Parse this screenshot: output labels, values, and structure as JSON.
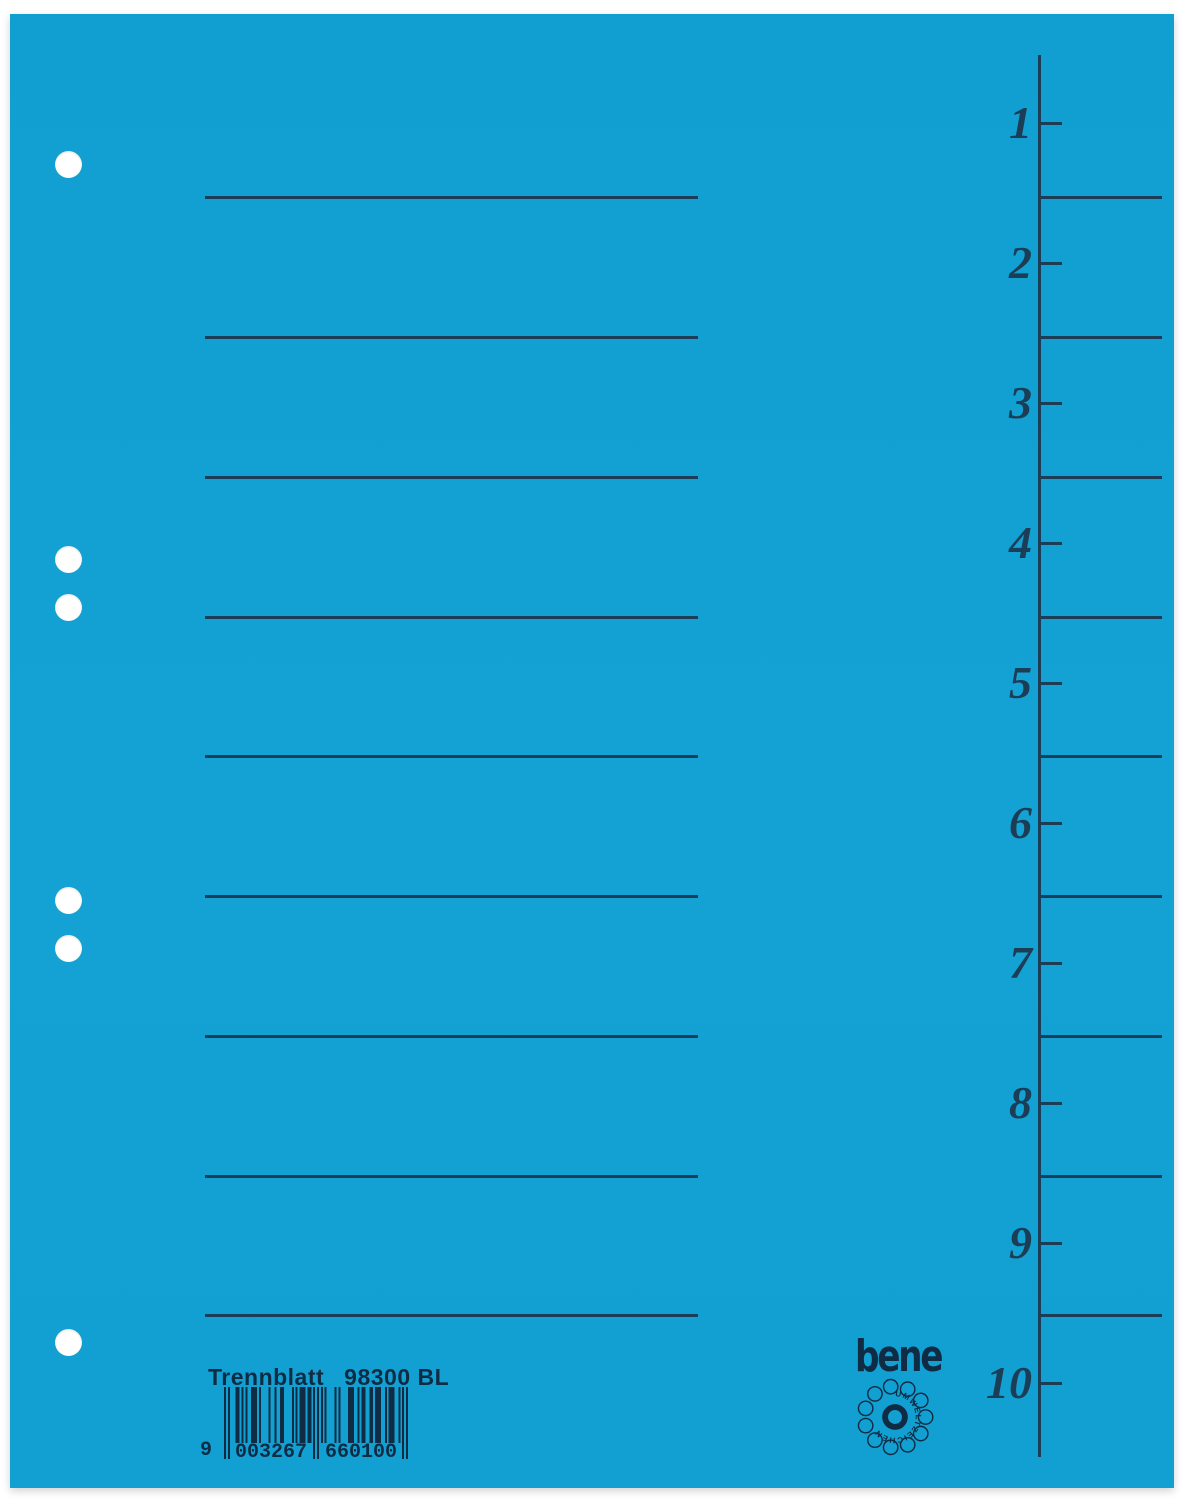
{
  "colors": {
    "sheet_blue": "#12a1d3",
    "mark_dark": "#1c3d56",
    "ink_dark": "#0f2c44",
    "hole_white": "#ffffff",
    "background_white": "#ffffff"
  },
  "product": {
    "label": "Trennblatt",
    "article": "98300 BL",
    "brand": "bene",
    "eco_text": "UMWELTZEICHEN"
  },
  "barcode": {
    "display": "9 003267 660100",
    "lead": "9",
    "group1": "003267",
    "group2": "660100",
    "value": "9003267660100",
    "ean13_pattern": "10100011010100111010000100100110000101011101101010101000010100001110010110011011100101110010101"
  },
  "index": {
    "numbers": [
      "1",
      "2",
      "3",
      "4",
      "5",
      "6",
      "7",
      "8",
      "9",
      "10"
    ]
  }
}
